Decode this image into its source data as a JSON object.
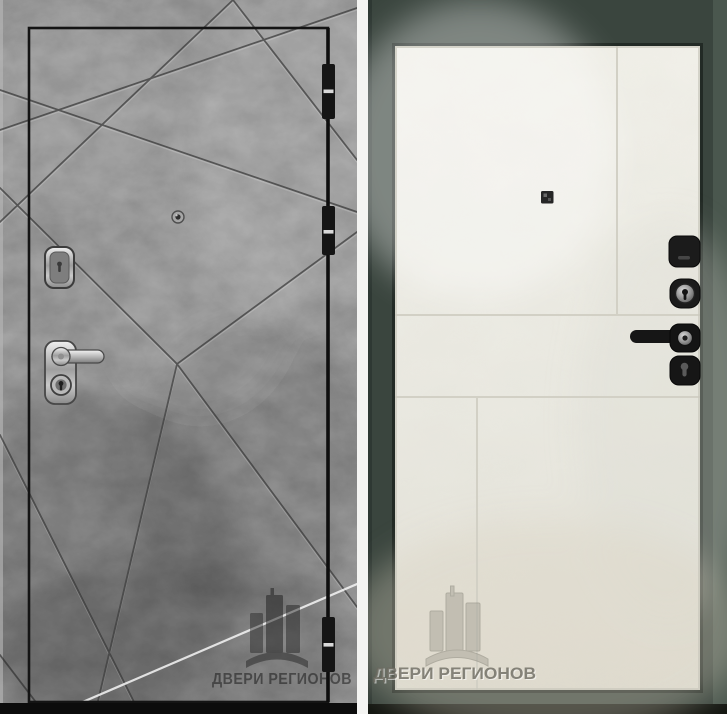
{
  "image": {
    "type": "product-photo",
    "subject": "steel entry door, exterior and interior sides"
  },
  "watermark": {
    "text": "ДВЕРИ РЕГИОНОВ",
    "logo": "city-buildings-over-arch"
  },
  "left_door": {
    "side": "exterior",
    "finish": "dark gray concrete with diagonal ray grooves",
    "colors": {
      "surface": "#8a8a8a",
      "groove": "#2e2e2e",
      "leaf_outline": "#141414",
      "highlight_line": "#f2f2f2",
      "hardware_chrome": "#c9c9c9"
    },
    "hardware": [
      "hinge-top",
      "hinge-middle",
      "hinge-bottom",
      "peephole",
      "key-escutcheon",
      "lever-handle",
      "cylinder-lock"
    ]
  },
  "right_door": {
    "side": "interior",
    "finish": "light beige flat panel with grooves",
    "colors": {
      "surface": "#e9e8e0",
      "frame": "#3a453e",
      "groove": "#d4d2c7",
      "hardware_black": "#1a1a1a"
    },
    "hardware": [
      "square-peephole",
      "night-latch",
      "cylinder-lock",
      "lever-handle",
      "keyhole-escutcheon"
    ]
  }
}
